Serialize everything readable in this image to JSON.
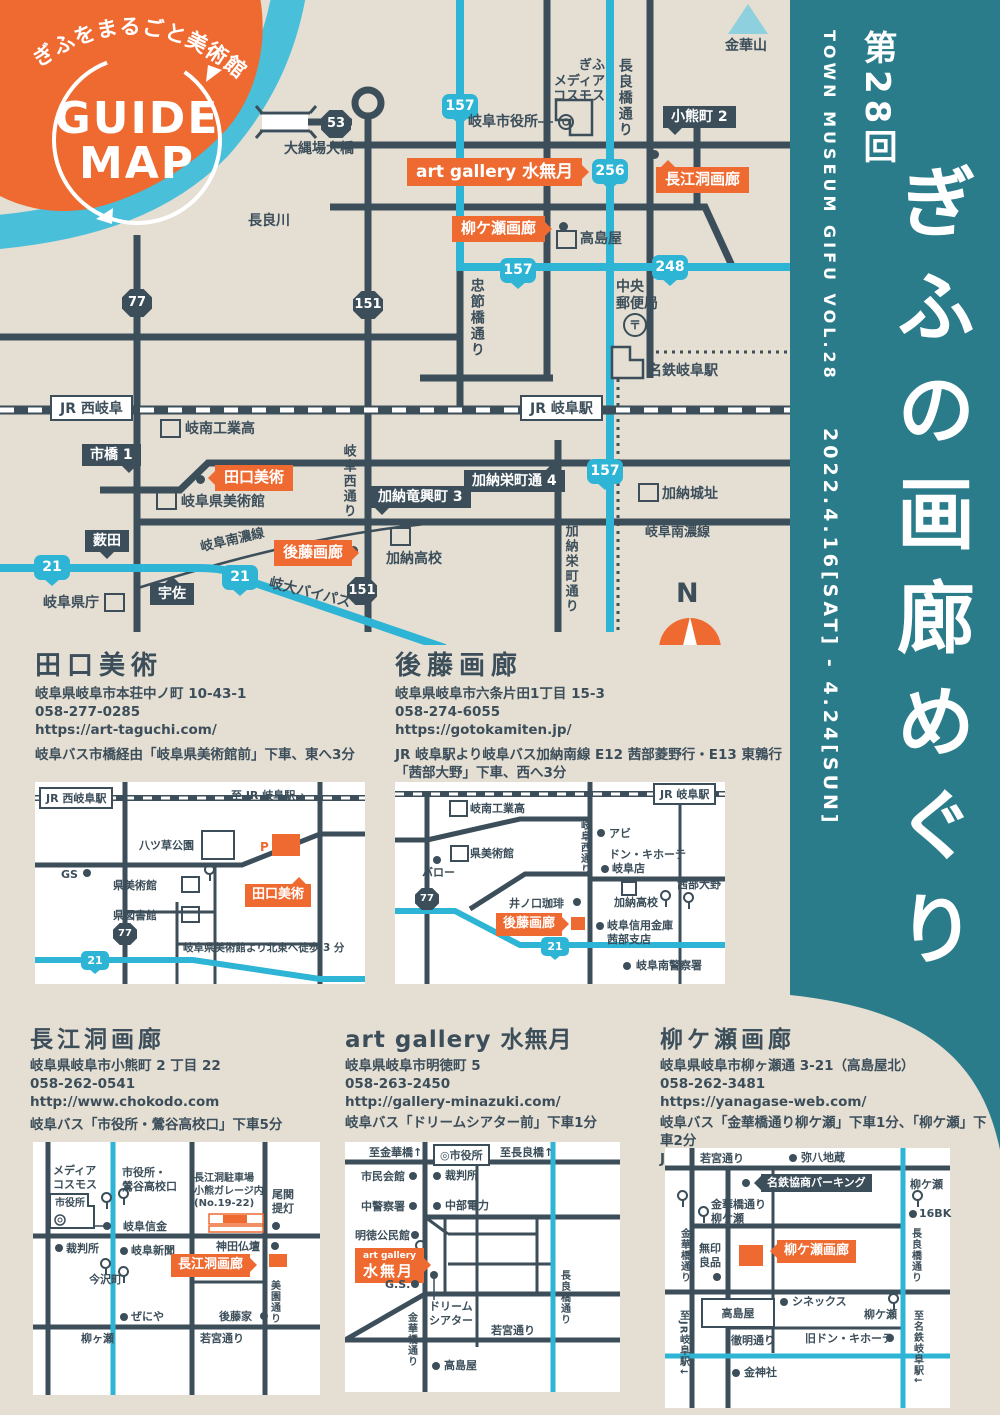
{
  "colors": {
    "bg": "#e4ded3",
    "teal": "#2a7c8b",
    "orange": "#ee6a30",
    "dark": "#3c4e5a",
    "cyan": "#2eb4d4",
    "river": "#49bfd9",
    "mountain": "#8fd0de",
    "white": "#ffffff"
  },
  "header_blob": {
    "ribbon": "ぎふをまるごと美術館に",
    "title_line1": "GUIDE",
    "title_line2": "MAP"
  },
  "sidebar": {
    "series": "TOWN MUSEUM GIFU VOL.28",
    "edition": "第28回",
    "title": "ぎふの画廊めぐり",
    "dates": "2022.4.16[SAT] - 4.24[SUN]"
  },
  "main_map": {
    "labels": {
      "nagara_river": "長良川",
      "onawaba_bridge": "大縄場大橋",
      "kinkazan": "金華山",
      "city_hall": "岐阜市役所",
      "media_cosmos": "ぎふ\nメディア\nコスモス",
      "nagarabashi_st": "長良橋通り",
      "chusetsubashi_st": "忠節橋通り",
      "takashimaya": "高島屋",
      "central_post": "中央\n郵便局",
      "postal_mark": "〒",
      "meitetsu_sta": "名鉄岐阜駅",
      "jr_nishi_gifu": "JR 西岐阜",
      "jr_gifu_sta": "JR 岐阜駅",
      "ginan_tech": "岐南工業高",
      "pref_museum": "岐阜県美術館",
      "gifu_nishi_st": "岐阜西通り",
      "kano_castle": "加納城址",
      "kano_hs": "加納高校",
      "kano_sakaemachi_st": "加納栄町通り",
      "nannosen_w": "岐阜南濃線",
      "nannosen_e": "岐阜南濃線",
      "pref_office": "岐阜県庁",
      "gidai_bypass": "岐大バイパス",
      "oguma2": "小熊町 2",
      "ichihashi1": "市橋 1",
      "yabuta": "薮田",
      "usa": "宇佐",
      "kano_ryuko3": "加納竜興町 3",
      "kano_sakae4": "加納栄町通 4",
      "compass_n": "N"
    },
    "gallery_tags": {
      "minazuki": "art gallery 水無月",
      "yanagase": "柳ケ瀬画廊",
      "chokodo": "長江洞画廊",
      "taguchi": "田口美術",
      "goto": "後藤画廊"
    },
    "shields": {
      "r53": "53",
      "r77": "77",
      "r151a": "151",
      "r151b": "151",
      "r157a": "157",
      "r157b": "157",
      "r157c": "157",
      "r256": "256",
      "r248": "248",
      "r21a": "21",
      "r21b": "21"
    }
  },
  "galleries": {
    "taguchi": {
      "name": "田口美術",
      "address": "岐阜県岐阜市本荘中ノ町 10-43-1",
      "tel": "058-277-0285",
      "url": "https://art-taguchi.com/",
      "access": "岐阜バス市橋経由「岐阜県美術館前」下車、東へ3分",
      "map": {
        "jr_nishi": "JR 西岐阜駅",
        "to_jr": "至 JR 岐阜駅→",
        "park": "八ツ草公園",
        "gs": "GS",
        "museum": "県美術館",
        "library": "県図書館",
        "p": "P",
        "tag": "田口美術",
        "r77": "77",
        "r21": "21",
        "note": "岐阜県美術館より北東へ徒歩 3 分"
      }
    },
    "goto": {
      "name": "後藤画廊",
      "address": "岐阜県岐阜市六条片田1丁目 15-3",
      "tel": "058-274-6055",
      "url": "https://gotokamiten.jp/",
      "access": "JR 岐阜駅より岐阜バス加納南線 E12 茜部菱野行・E13 東鶉行\n「茜部大野」下車、西へ3分",
      "map": {
        "jr": "JR 岐阜駅",
        "ginan": "岐南工業高",
        "nishi": "岐阜西通り",
        "abi": "アビ",
        "donki": "ドン・キホーテ",
        "donki_branch": "岐阜店",
        "museum": "県美術館",
        "valor": "バロー",
        "r77": "77",
        "inokuchi": "井ノ口珈琲",
        "kano": "加納高校",
        "akabe": "茜部大野",
        "tag": "後藤画廊",
        "shinkin": "岐阜信用金庫\n茜部支店",
        "r21": "21",
        "police": "岐阜南警察署"
      }
    },
    "chokodo": {
      "name": "長江洞画廊",
      "address": "岐阜県岐阜市小熊町 2 丁目 22",
      "tel": "058-262-0541",
      "url": "http://www.chokodo.com",
      "access": "岐阜バス「市役所・鶯谷高校口」下車5分",
      "map": {
        "media": "メディア\nコスモス",
        "cityhall": "市役所",
        "mark": "◎",
        "bus": "市役所・\n鶯谷高校口",
        "parking": "長江洞駐車場\n小熊ガレージ内\n(No.19-22)",
        "ozeki": "尾関\n提灯",
        "shinkin": "岐阜信金",
        "court": "裁判所",
        "press": "岐阜新聞",
        "kanda": "神田仏壇",
        "tag": "長江洞画廊",
        "imazawa": "今沢町",
        "misono": "美園通り",
        "zeniya": "ぜにや",
        "gotoke": "後藤家",
        "yanagase": "柳ヶ瀬",
        "wakamiya": "若宮通り"
      }
    },
    "minazuki": {
      "name": "art gallery 水無月",
      "address": "岐阜県岐阜市明徳町 5",
      "tel": "058-263-2450",
      "url": "http://gallery-minazuki.com/",
      "access": "岐阜バス「ドリームシアター前」下車1分",
      "map": {
        "to_kinka": "至金華橋↑",
        "cityhall": "◎市役所",
        "to_nagara": "至長良橋↑",
        "shimin": "市民会館",
        "court": "裁判所",
        "police": "中警察署",
        "chubu": "中部電力",
        "meitoku": "明徳公民館",
        "tag1": "art gallery",
        "tag2": "水無月",
        "gs": "G.S.",
        "dream": "ドリーム\nシアター",
        "wakamiya": "若宮通り",
        "kinka": "金華橋通り",
        "nagara": "長良橋通り",
        "takashimaya": "高島屋"
      }
    },
    "yanagase": {
      "name": "柳ケ瀬画廊",
      "address": "岐阜県岐阜市柳ヶ瀬通 3-21（高島屋北）",
      "tel": "058-262-3481",
      "url": "https://yanagase-web.com/",
      "access": "岐阜バス「金華橋通り柳ケ瀬」下車1分、「柳ケ瀬」下車2分\nJR・名鉄岐阜駅より徒歩 18 分",
      "map": {
        "wakamiya": "若宮通り",
        "yahachi": "弥八地蔵",
        "parking": "名鉄協商パーキング",
        "bus1": "柳ケ瀬",
        "bk": "16BK",
        "bus2": "金華橋通り\n柳ケ瀬",
        "kinka": "金華橋通り",
        "tag": "柳ケ瀬画廊",
        "muji": "無印\n良品",
        "nagara": "長良橋通り",
        "takashimaya": "高島屋",
        "cinex": "シネックス",
        "bus3": "柳ケ瀬",
        "to_jr": "至JR岐阜駅↓",
        "tetsumei": "徹明通り",
        "donki": "旧ドン・キホーテ",
        "to_meitetsu": "至名鉄岐阜駅↓",
        "konjinja": "金神社"
      }
    }
  }
}
